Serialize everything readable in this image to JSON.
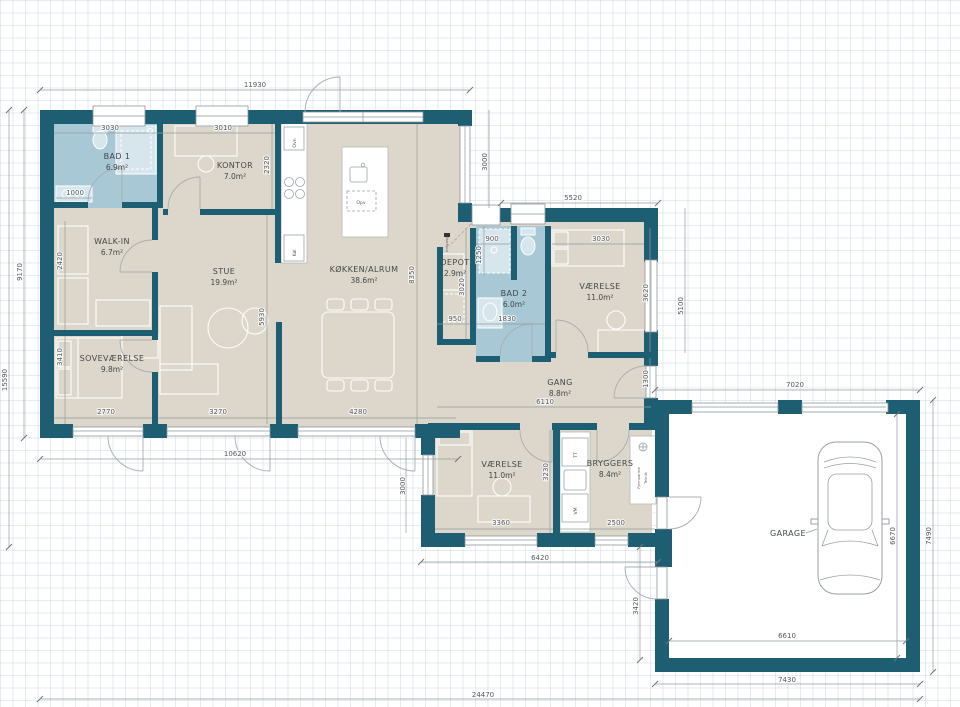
{
  "colors": {
    "wall": "#1d5e72",
    "floor": "#dcd7ca",
    "bath_floor": "#a7c8d4",
    "garage_floor": "#ffffff",
    "grid_line": "#dfe6ea",
    "dimension_text": "#54595c"
  },
  "rooms": {
    "bad1": {
      "name": "BAD 1",
      "area": "6.9m²"
    },
    "kontor": {
      "name": "KONTOR",
      "area": "7.0m²"
    },
    "walkin": {
      "name": "WALK-IN",
      "area": "6.7m²"
    },
    "stue": {
      "name": "STUE",
      "area": "19.9m²"
    },
    "koekken": {
      "name": "KØKKEN/ALRUM",
      "area": "38.6m²"
    },
    "sovevaerelse": {
      "name": "SOVEVÆRELSE",
      "area": "9.8m²"
    },
    "depot": {
      "name": "DEPOT",
      "area": "2.9m²"
    },
    "bad2": {
      "name": "BAD 2",
      "area": "6.0m²"
    },
    "vaerelse_ne": {
      "name": "VÆRELSE",
      "area": "11.0m²"
    },
    "gang": {
      "name": "GANG",
      "area": "8.8m²"
    },
    "vaerelse_s": {
      "name": "VÆRELSE",
      "area": "11.0m²"
    },
    "bryggers": {
      "name": "BRYGGERS",
      "area": "8.4m²"
    },
    "garage": {
      "name": "GARAGE"
    }
  },
  "fixtures": {
    "oven": "Ovn",
    "fridge": "Køl",
    "dishwasher": "Opv",
    "dryer": "TT",
    "washer": "VM",
    "district_heating": "Fjernvarme",
    "utilities": "Teknik",
    "entrance": "Indgang"
  },
  "dimensions_mm": {
    "overall_top": "11930",
    "bad1_width": "3030",
    "kontor_width": "3010",
    "bad1_vanity": "1000",
    "left_inner_height": "9170",
    "left_total_height": "15590",
    "walkin_height": "2420",
    "sovevaerelse_height": "3410",
    "kontor_depth": "2320",
    "stue_height": "5930",
    "koekken_height": "8350",
    "koekken_right_height": "3000",
    "wing_top_width": "5520",
    "bad2_niche_width": "900",
    "bad2_niche_height": "1250",
    "depot_height": "3020",
    "depot_width": "950",
    "bad2_width": "1830",
    "vaerelse_ne_width": "3030",
    "vaerelse_ne_height": "3620",
    "wing_right_height": "5100",
    "gang_right": "1300",
    "sovevaerelse_width": "2770",
    "stue_width": "3270",
    "koekken_width": "4280",
    "gang_width": "6110",
    "main_bottom_width": "10620",
    "wing_left_height": "3000",
    "vaerelse_s_width": "3360",
    "vaerelse_s_height": "3230",
    "bryggers_width": "2500",
    "wing_bottom_width": "6420",
    "garage_top_width": "7020",
    "garage_inner_height": "6670",
    "garage_right_height": "7490",
    "garage_inner_width": "6610",
    "garage_bottom_width": "7430",
    "garage_left_height": "3420",
    "overall_bottom": "24470"
  }
}
